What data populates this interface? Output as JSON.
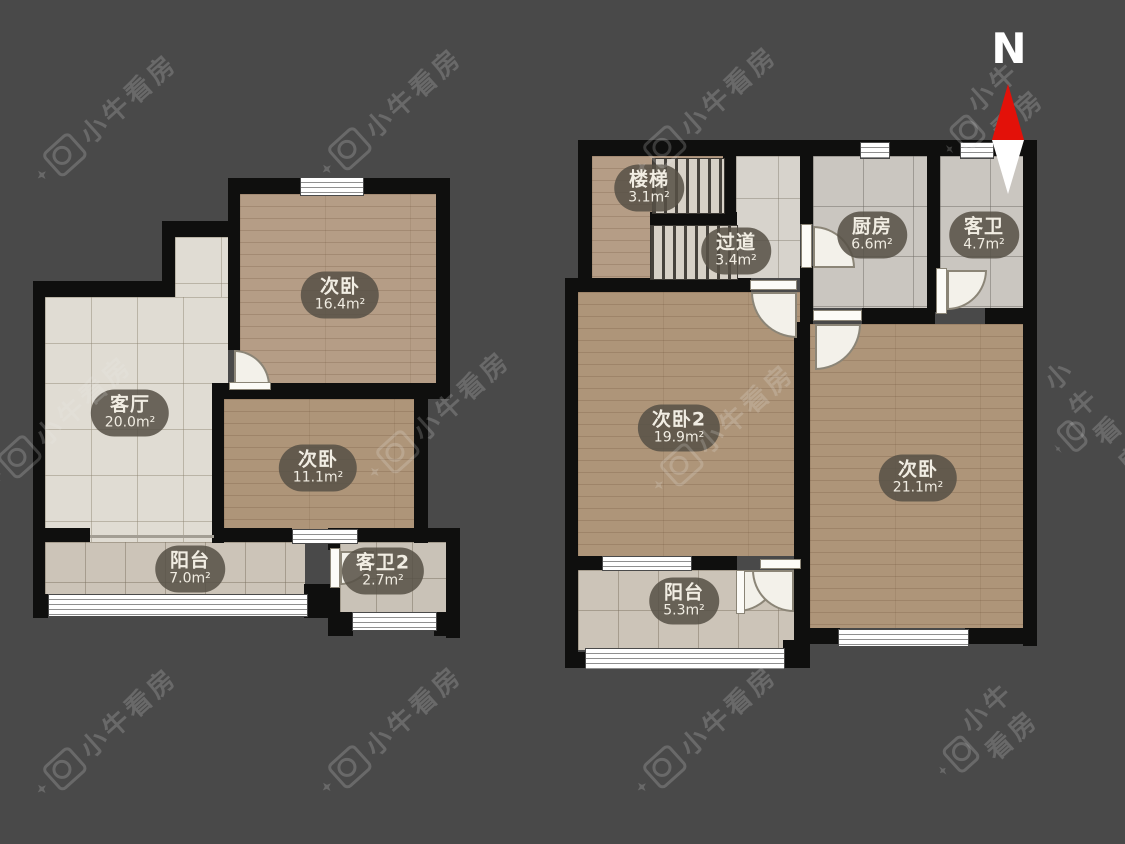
{
  "meta": {
    "background_color": "#494949",
    "wall_color": "#0f0f0e",
    "north_arrow_red": "#e31109"
  },
  "north": {
    "label": "N"
  },
  "watermark": {
    "text": "小牛看房"
  },
  "floor1": {
    "rooms": [
      {
        "id": "bedroom-16",
        "name": "次卧",
        "area": "16.4m²"
      },
      {
        "id": "living",
        "name": "客厅",
        "area": "20.0m²"
      },
      {
        "id": "bedroom-11",
        "name": "次卧",
        "area": "11.1m²"
      },
      {
        "id": "balcony",
        "name": "阳台",
        "area": "7.0m²"
      },
      {
        "id": "bath2",
        "name": "客卫2",
        "area": "2.7m²"
      }
    ]
  },
  "floor2": {
    "rooms": [
      {
        "id": "stairs",
        "name": "楼梯",
        "area": "3.1m²"
      },
      {
        "id": "hallway",
        "name": "过道",
        "area": "3.4m²"
      },
      {
        "id": "kitchen",
        "name": "厨房",
        "area": "6.6m²"
      },
      {
        "id": "bath",
        "name": "客卫",
        "area": "4.7m²"
      },
      {
        "id": "bedroom2",
        "name": "次卧2",
        "area": "19.9m²"
      },
      {
        "id": "bedroom-21",
        "name": "次卧",
        "area": "21.1m²"
      },
      {
        "id": "balcony2",
        "name": "阳台",
        "area": "5.3m²"
      }
    ]
  }
}
